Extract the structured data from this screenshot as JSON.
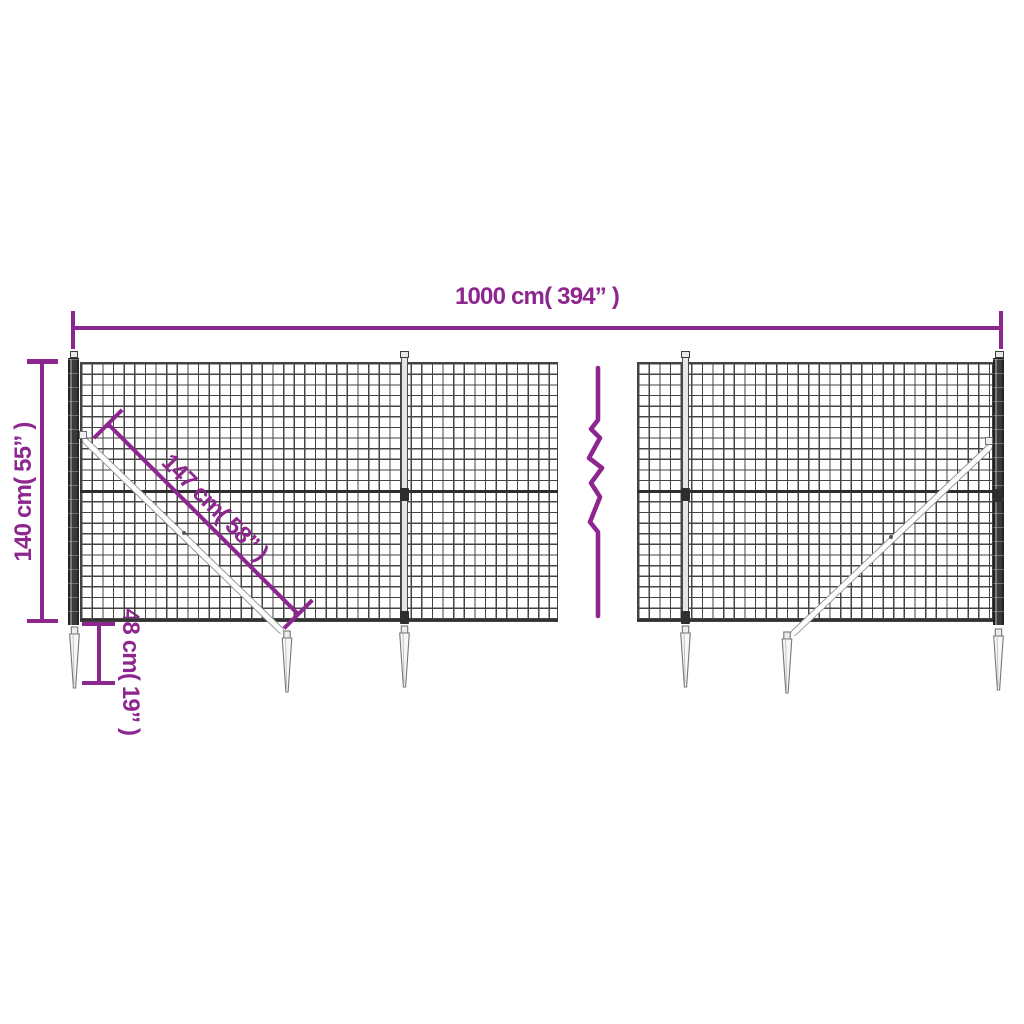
{
  "page": {
    "description": "Product dimension diagram of a wire mesh fence panel with posts, diagonal braces and ground anchor spikes",
    "background": "#ffffff"
  },
  "colors": {
    "accent": "#8E268F",
    "mesh_wire": "#454545",
    "post_anthracite": "#3a3a3a",
    "hardware_gray": "#8f8f8f"
  },
  "annotations": {
    "total_width": {
      "label": "1000 cm( 394” )",
      "cm": 1000,
      "inches": 394,
      "orientation": "horizontal-top"
    },
    "fence_height": {
      "label": "140 cm( 55” )",
      "cm": 140,
      "inches": 55,
      "orientation": "vertical-left"
    },
    "brace_length": {
      "label": "147 cm( 58” )",
      "cm": 147,
      "inches": 58,
      "orientation": "diagonal-45deg"
    },
    "spike_depth": {
      "label": "48 cm( 19” )",
      "cm": 48,
      "inches": 19,
      "orientation": "vertical-bottom-left"
    }
  },
  "icons": {
    "break_mark": "zigzag-continuation-line"
  }
}
